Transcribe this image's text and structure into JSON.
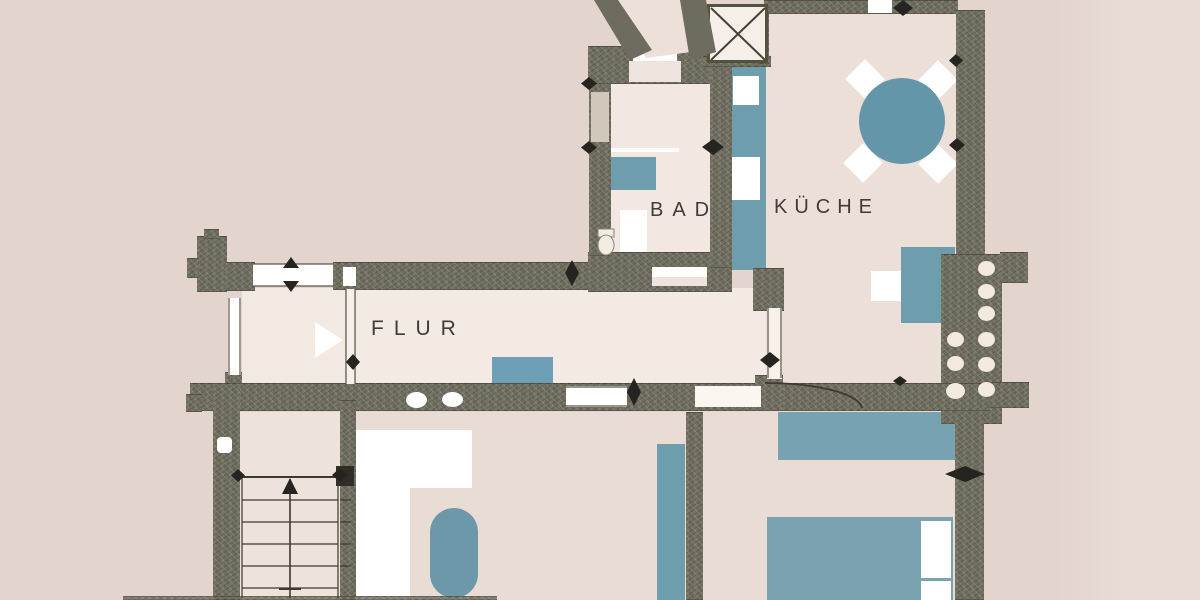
{
  "floorplan": {
    "rooms": [
      {
        "id": "bad",
        "label": "BAD"
      },
      {
        "id": "kueche",
        "label": "KÜCHE"
      },
      {
        "id": "flur",
        "label": "FLUR"
      }
    ],
    "colors": {
      "background": "#e4d6ce",
      "room_fill": "#f2e8e1",
      "wall": "#6d6c5e",
      "furniture_blue": "#6e9dae",
      "fixture_white": "#ffffff",
      "linework": "#3a372e"
    },
    "fixtures": [
      "staircase",
      "entrance-arrow",
      "dining-table",
      "chairs",
      "kitchen-counter",
      "sink",
      "toilet",
      "bed",
      "pillows",
      "wardrobe",
      "rug",
      "bathtub",
      "chimney-flues",
      "door-swing-arc",
      "ventilation-shaft"
    ]
  }
}
